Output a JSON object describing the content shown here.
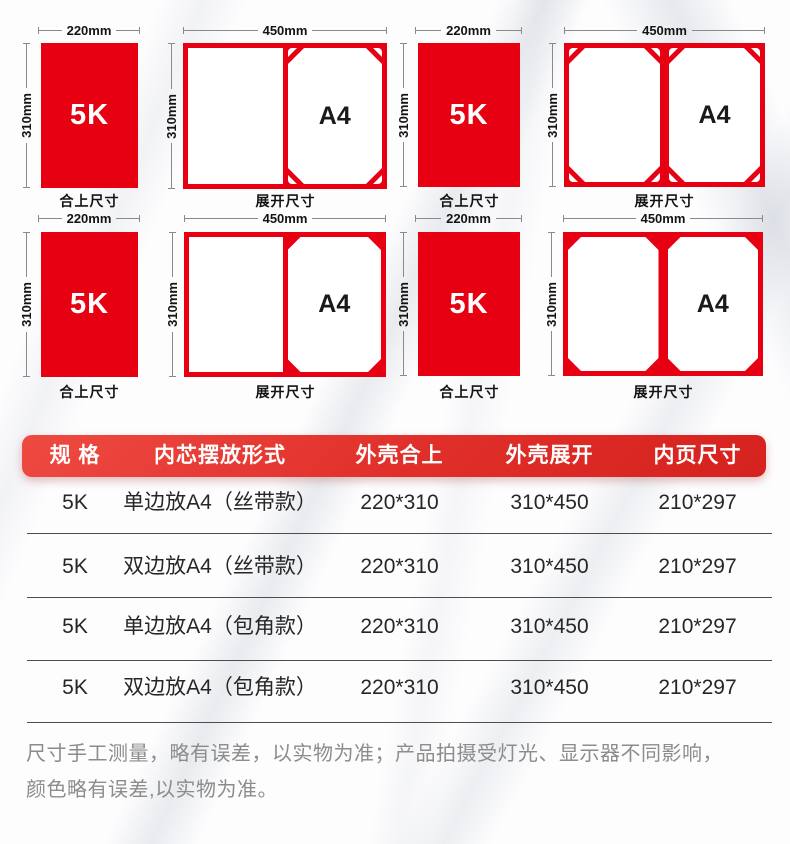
{
  "colors": {
    "red": "#e60012",
    "header_red_start": "#ee4a42",
    "header_red_end": "#d6221e",
    "dim_line_gray": "#8a8a8a",
    "table_divider_gray": "#4d4d4d",
    "footer_text_gray": "#8c8c8c"
  },
  "diagrams": {
    "closed_width_label": "220mm",
    "open_width_label": "450mm",
    "height_label": "310mm",
    "closed_size_text": "5K",
    "inner_page_text": "A4",
    "closed_caption": "合上尺寸",
    "open_caption": "展开尺寸"
  },
  "table": {
    "headers": [
      "规 格",
      "内芯摆放形式",
      "外壳合上",
      "外壳展开",
      "内页尺寸"
    ],
    "rows": [
      [
        "5K",
        "单边放A4（丝带款）",
        "220*310",
        "310*450",
        "210*297"
      ],
      [
        "5K",
        "双边放A4（丝带款）",
        "220*310",
        "310*450",
        "210*297"
      ],
      [
        "5K",
        "单边放A4（包角款）",
        "220*310",
        "310*450",
        "210*297"
      ],
      [
        "5K",
        "双边放A4（包角款）",
        "220*310",
        "310*450",
        "210*297"
      ]
    ]
  },
  "footer": {
    "line1": "尺寸手工测量，略有误差，以实物为准；产品拍摄受灯光、显示器不同影响，",
    "line2": "颜色略有误差,以实物为准。"
  }
}
